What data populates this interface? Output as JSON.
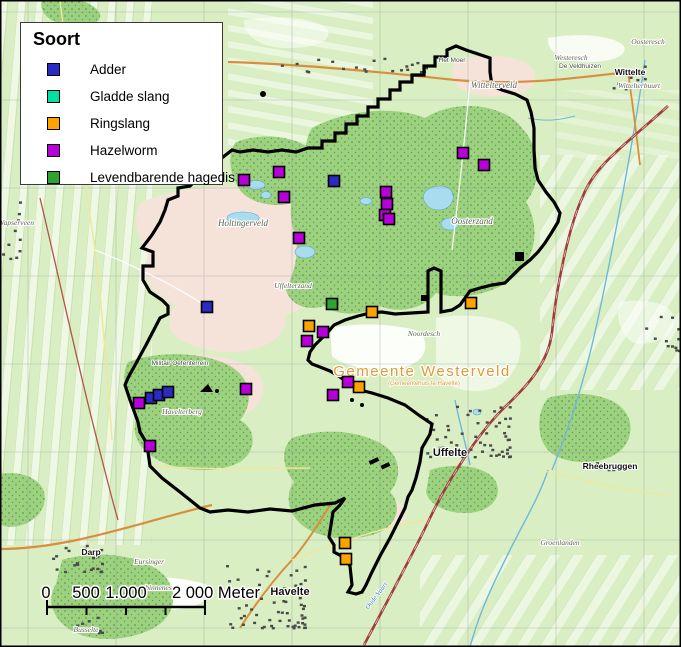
{
  "legend": {
    "title": "Soort",
    "items": [
      {
        "id": "adder",
        "label": "Adder",
        "color": "#2a2ac4"
      },
      {
        "id": "gladde-slang",
        "label": "Gladde slang",
        "color": "#00e0a0"
      },
      {
        "id": "ringslang",
        "label": "Ringslang",
        "color": "#ffa200"
      },
      {
        "id": "hazelworm",
        "label": "Hazelworm",
        "color": "#b800da"
      },
      {
        "id": "levendbarende-hagedis",
        "label": "Levendbarende hagedis",
        "color": "#2fa32f"
      }
    ]
  },
  "scalebar": {
    "labels": [
      {
        "text": "0",
        "x": 46
      },
      {
        "text": "500",
        "x": 86
      },
      {
        "text": "1.000",
        "x": 126
      },
      {
        "text": "2 000 Meter",
        "x": 216
      }
    ],
    "bar_x1": 47,
    "bar_x2": 205,
    "bar_y": 607,
    "ticks": [
      47,
      86.5,
      126,
      165.5,
      205
    ]
  },
  "observations": {
    "adder": [
      [
        334,
        181
      ],
      [
        207,
        307
      ],
      [
        151,
        398
      ],
      [
        159,
        395
      ],
      [
        168,
        392
      ]
    ],
    "gladde_slang": [],
    "ringslang": [
      [
        309,
        326
      ],
      [
        372,
        312
      ],
      [
        471,
        303
      ],
      [
        359,
        387
      ],
      [
        345,
        543
      ],
      [
        346,
        559
      ]
    ],
    "hazelworm": [
      [
        244,
        180
      ],
      [
        279,
        172
      ],
      [
        284,
        197
      ],
      [
        299,
        238
      ],
      [
        386,
        192
      ],
      [
        387,
        204
      ],
      [
        385,
        215
      ],
      [
        389,
        219
      ],
      [
        463,
        153
      ],
      [
        484,
        165
      ],
      [
        323,
        332
      ],
      [
        307,
        341
      ],
      [
        348,
        382
      ],
      [
        333,
        395
      ],
      [
        139,
        403
      ],
      [
        246,
        389
      ],
      [
        150,
        446
      ]
    ],
    "levendbarende_hagedis": [
      [
        332,
        304
      ]
    ]
  },
  "species_colors": {
    "adder": "#2a2ac4",
    "gladde_slang": "#00e0a0",
    "ringslang": "#ffa200",
    "hazelworm": "#b800da",
    "levendbarende_hagedis": "#2fa32f"
  },
  "map_labels": [
    {
      "text": "Holtingerveld",
      "x": 243,
      "y": 226,
      "cls": "t-area"
    },
    {
      "text": "Oosterzand",
      "x": 472,
      "y": 224,
      "cls": "t-area"
    },
    {
      "text": "Wittelterveld",
      "x": 494,
      "y": 88,
      "cls": "t-area"
    },
    {
      "text": "Westeresch",
      "x": 571,
      "y": 60,
      "cls": "t-area-sm"
    },
    {
      "text": "Oosteresch",
      "x": 648,
      "y": 44,
      "cls": "t-area-sm"
    },
    {
      "text": "Wittelte",
      "x": 630,
      "y": 75,
      "cls": "t-town"
    },
    {
      "text": "Wittelterbuurt",
      "x": 639,
      "y": 88,
      "cls": "t-area-sm"
    },
    {
      "text": "De Veldhuizen",
      "x": 580,
      "y": 68,
      "cls": "t-tiny"
    },
    {
      "text": "Het Moer",
      "x": 452,
      "y": 62,
      "cls": "t-tiny"
    },
    {
      "text": "Gemeente Westerveld",
      "x": 422,
      "y": 376,
      "cls": "t-muni"
    },
    {
      "text": "(Gemeentehuis te Havelte)",
      "x": 424,
      "y": 385,
      "cls": "t-muni-sub"
    },
    {
      "text": "Noordesch",
      "x": 424,
      "y": 336,
      "cls": "t-area-sm"
    },
    {
      "text": "Uffelterzand",
      "x": 293,
      "y": 288,
      "cls": "t-area-sm"
    },
    {
      "text": "Uffelte",
      "x": 450,
      "y": 456,
      "cls": "t-town-lg"
    },
    {
      "text": "Rheebruggen",
      "x": 610,
      "y": 469,
      "cls": "t-town"
    },
    {
      "text": "Groenlanden",
      "x": 560,
      "y": 545,
      "cls": "t-area-sm"
    },
    {
      "text": "Havelte",
      "x": 290,
      "y": 595,
      "cls": "t-town-lg"
    },
    {
      "text": "Darp",
      "x": 91,
      "y": 555,
      "cls": "t-town"
    },
    {
      "text": "Eursinger",
      "x": 149,
      "y": 564,
      "cls": "t-area-sm"
    },
    {
      "text": "binnenesch",
      "x": 162,
      "y": 590,
      "cls": "t-area-sm"
    },
    {
      "text": "Busselte",
      "x": 86,
      "y": 632,
      "cls": "t-area-sm"
    },
    {
      "text": "Havelterberg",
      "x": 182,
      "y": 414,
      "cls": "t-area-sm"
    },
    {
      "text": "Militair Oefenterrein",
      "x": 180,
      "y": 365,
      "cls": "t-tiny"
    },
    {
      "text": "Wapserveen",
      "x": 16,
      "y": 225,
      "cls": "t-area-sm"
    },
    {
      "text": "Oude Vaart",
      "x": 378,
      "y": 597,
      "cls": "t-water",
      "rotate": -52
    }
  ]
}
